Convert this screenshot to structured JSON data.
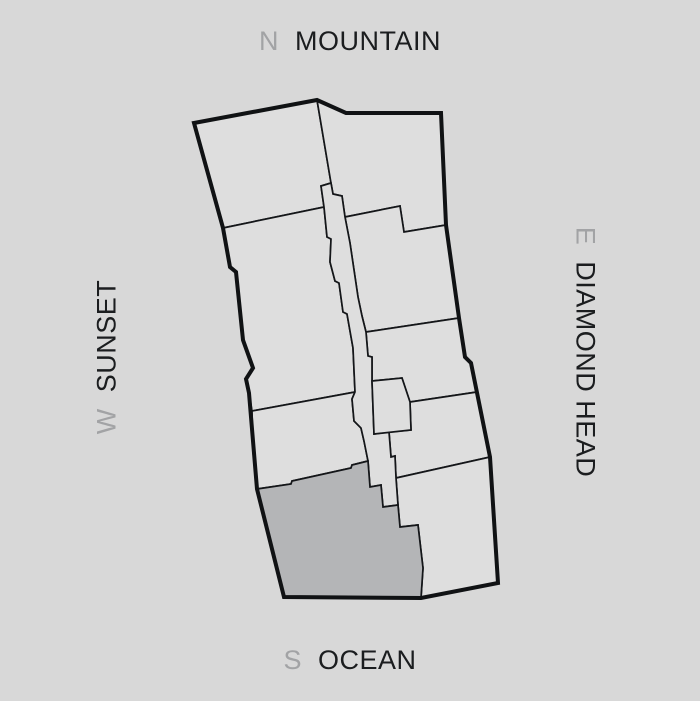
{
  "canvas": {
    "width": 700,
    "height": 701
  },
  "colors": {
    "background": "#d8d8d8",
    "unit_fill": "#dedede",
    "corridor_fill": "#dedede",
    "highlight_fill": "#b4b5b7",
    "outline_stroke": "#101214",
    "direction_letter": "#a2a3a5",
    "direction_word": "#1b1d1f"
  },
  "compass": {
    "north": {
      "letter": "N",
      "label": "MOUNTAIN"
    },
    "south": {
      "letter": "S",
      "label": "OCEAN"
    },
    "west": {
      "letter": "W",
      "label": "SUNSET"
    },
    "east": {
      "letter": "E",
      "label": "DIAMOND HEAD"
    }
  }
}
